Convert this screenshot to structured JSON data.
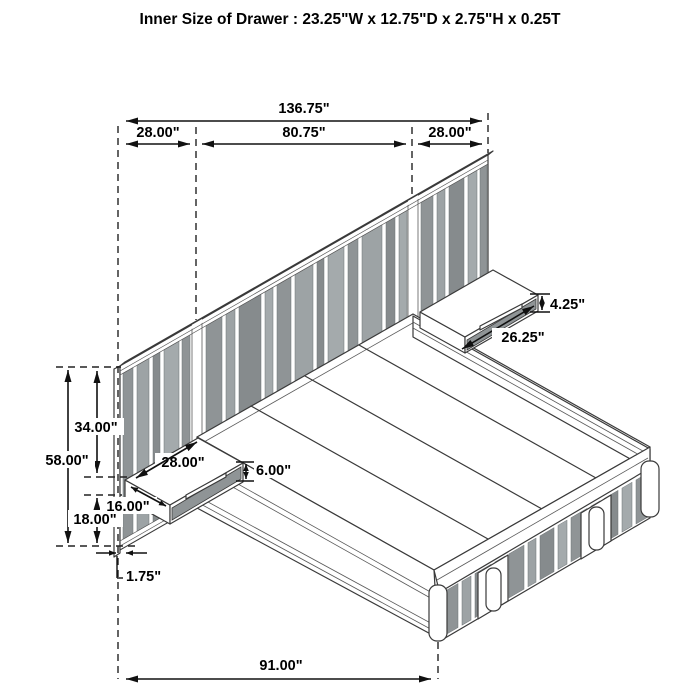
{
  "title": "Inner Size of Drawer : 23.25\"W x 12.75\"D x 2.75\"H x 0.25T",
  "dims": {
    "overall_width": "136.75\"",
    "left_panel_width": "28.00\"",
    "center_panel_width": "80.75\"",
    "right_panel_width": "28.00\"",
    "right_shelf_height": "4.25\"",
    "right_shelf_width": "26.25\"",
    "top_to_shelf": "34.00\"",
    "total_height": "58.00\"",
    "floor_to_shelf": "18.00\"",
    "shelf_front_depth": "16.00\"",
    "shelf_top_depth": "28.00\"",
    "left_shelf_height": "6.00\"",
    "panel_thickness": "1.75\"",
    "bed_length": "91.00\""
  },
  "colors": {
    "slat_gray": "#8f9496",
    "line": "#3a3a3a",
    "dimension": "#111111"
  }
}
